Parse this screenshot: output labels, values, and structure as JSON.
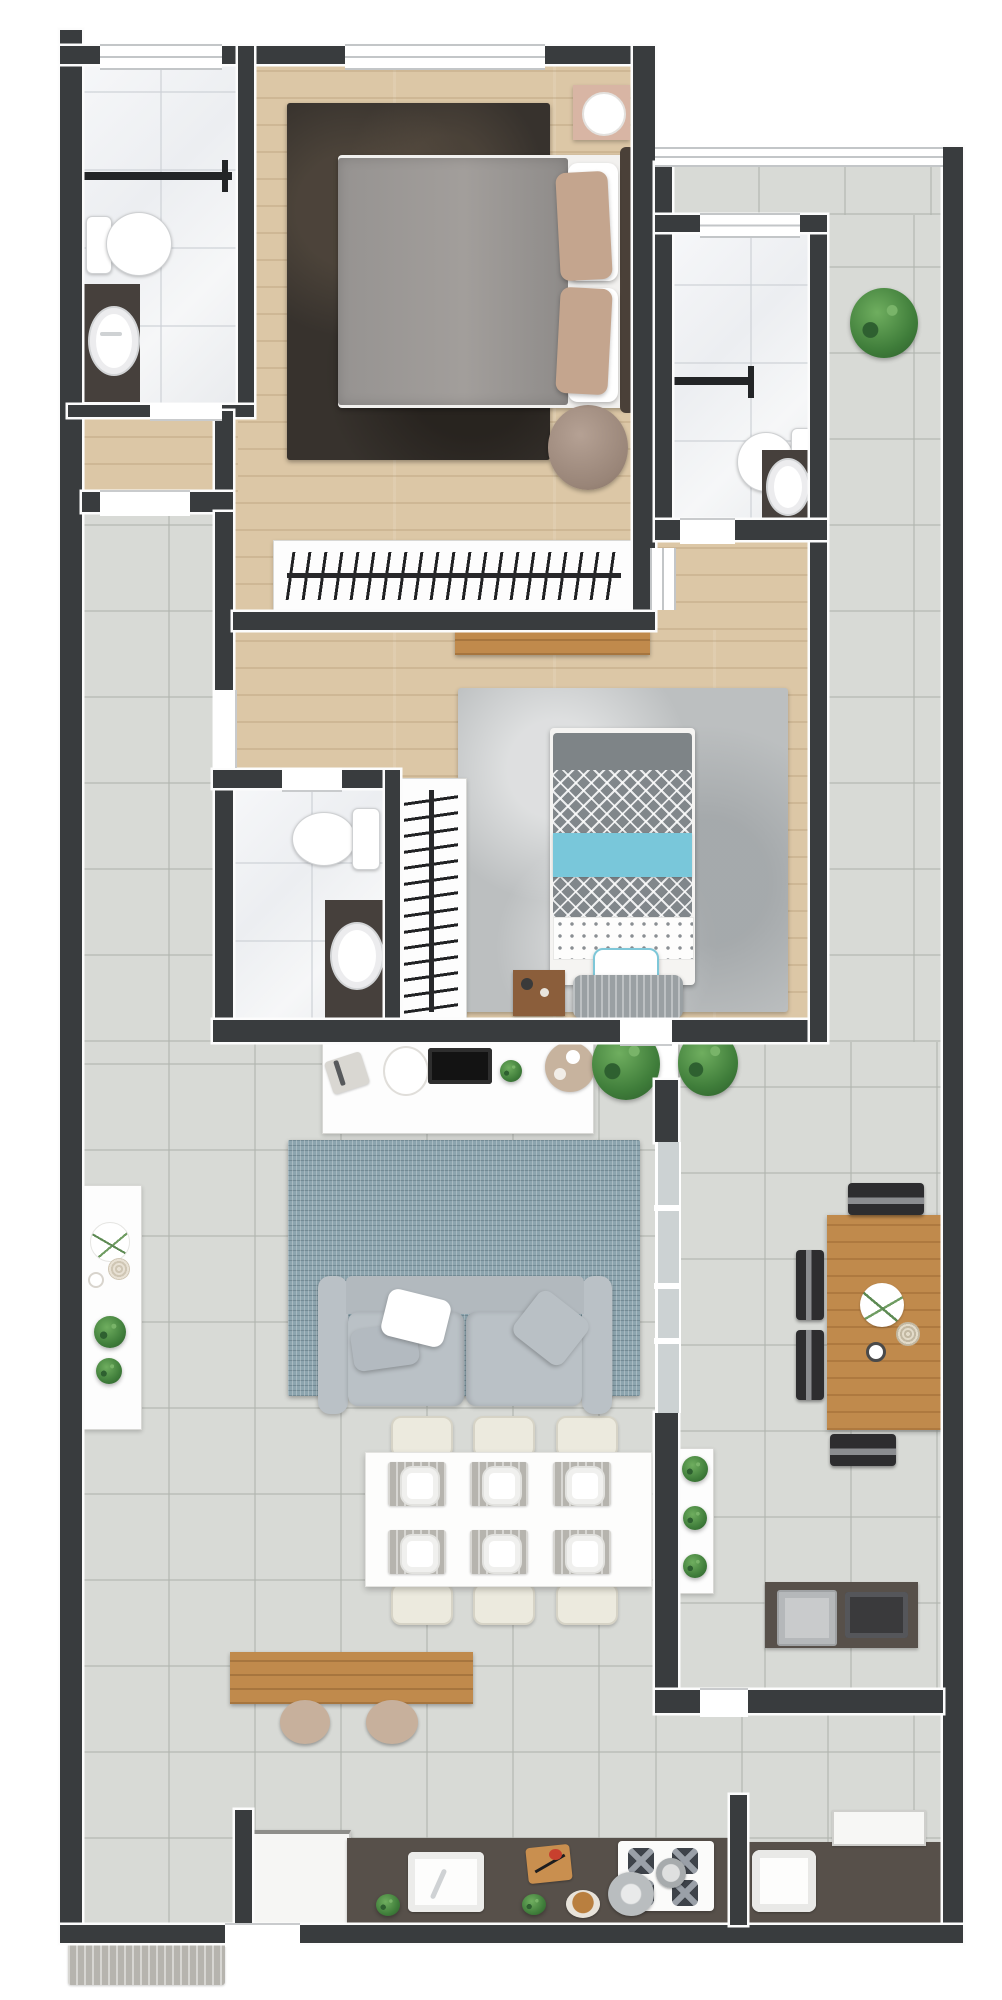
{
  "meta": {
    "type": "3d floor plan render",
    "view": "top-down",
    "units": "px",
    "canvas": {
      "width": 1002,
      "height": 2000
    }
  },
  "palette": {
    "wall": "#393c3e",
    "floor_wood": "#dcc7a6",
    "floor_tile": "#d8dad6",
    "floor_marble": "#f3f4f6",
    "rug_master": "#37322d",
    "rug_blue": "#8ca4ae",
    "rug_gray": "#bcbfc0",
    "sofa_gray": "#bac1c6",
    "accent_blue": "#79c7da",
    "wood_furniture": "#c08a4c",
    "counter_dark": "#57504a",
    "vanity_dark": "#46403c",
    "plant_green": "#4e8a46",
    "bed_chevron_gray": "#81878b",
    "nightstand_pink": "#d8b5a4"
  },
  "rooms": [
    {
      "name": "master-bathroom",
      "floor": "marble",
      "fixtures": [
        "toilet",
        "round-sink-vanity",
        "shower-divider",
        "window"
      ]
    },
    {
      "name": "master-bedroom",
      "floor": "wood",
      "fixtures": [
        "double-bed",
        "dark-marble-rug",
        "nightstand",
        "wall-lamp",
        "pouf",
        "wardrobe-with-hangers",
        "window"
      ]
    },
    {
      "name": "ensuite-bathroom",
      "floor": "marble",
      "fixtures": [
        "toilet",
        "round-sink-vanity",
        "shower-divider",
        "window"
      ]
    },
    {
      "name": "balcony-top",
      "floor": "tile",
      "fixtures": [
        "potted-plant",
        "glass-rail"
      ]
    },
    {
      "name": "second-bedroom",
      "floor": "wood",
      "fixtures": [
        "single-bed-chevron-blue",
        "gray-rug",
        "wall-shelf",
        "wardrobe-with-hangers",
        "bench",
        "side-tray"
      ]
    },
    {
      "name": "second-bathroom",
      "floor": "marble",
      "fixtures": [
        "toilet",
        "round-sink-vanity"
      ]
    },
    {
      "name": "hallway",
      "floor": "tile",
      "fixtures": []
    },
    {
      "name": "living-room",
      "floor": "tile",
      "fixtures": [
        "tv-console",
        "tv",
        "blue-rug",
        "sofa",
        "pillows",
        "dining-table-6-seats",
        "wood-bench",
        "stools",
        "side-console",
        "potted-plants"
      ]
    },
    {
      "name": "gourmet-terrace",
      "floor": "tile",
      "fixtures": [
        "wood-dining-table",
        "black-chairs",
        "plant-shelf",
        "grill-counter",
        "steel-sink",
        "glass-partition"
      ]
    },
    {
      "name": "kitchen",
      "floor": "tile",
      "fixtures": [
        "refrigerator",
        "counter",
        "sink",
        "cutting-board",
        "cooktop-4-burners",
        "pots",
        "plants",
        "fruit-bowl"
      ]
    },
    {
      "name": "laundry",
      "floor": "tile",
      "fixtures": [
        "utility-sink",
        "washer",
        "counter"
      ]
    }
  ],
  "door_openings": [
    "master-bath-door",
    "hall-to-master-door",
    "hall-to-bedroom2-door",
    "bedroom2-bath-door",
    "ensuite-door",
    "bedroom2-living-door",
    "terrace-service-door",
    "entry-door"
  ],
  "windows": [
    "master-bath-window",
    "master-window",
    "terrace-rail-window",
    "ensuite-window",
    "nook-side-window"
  ]
}
